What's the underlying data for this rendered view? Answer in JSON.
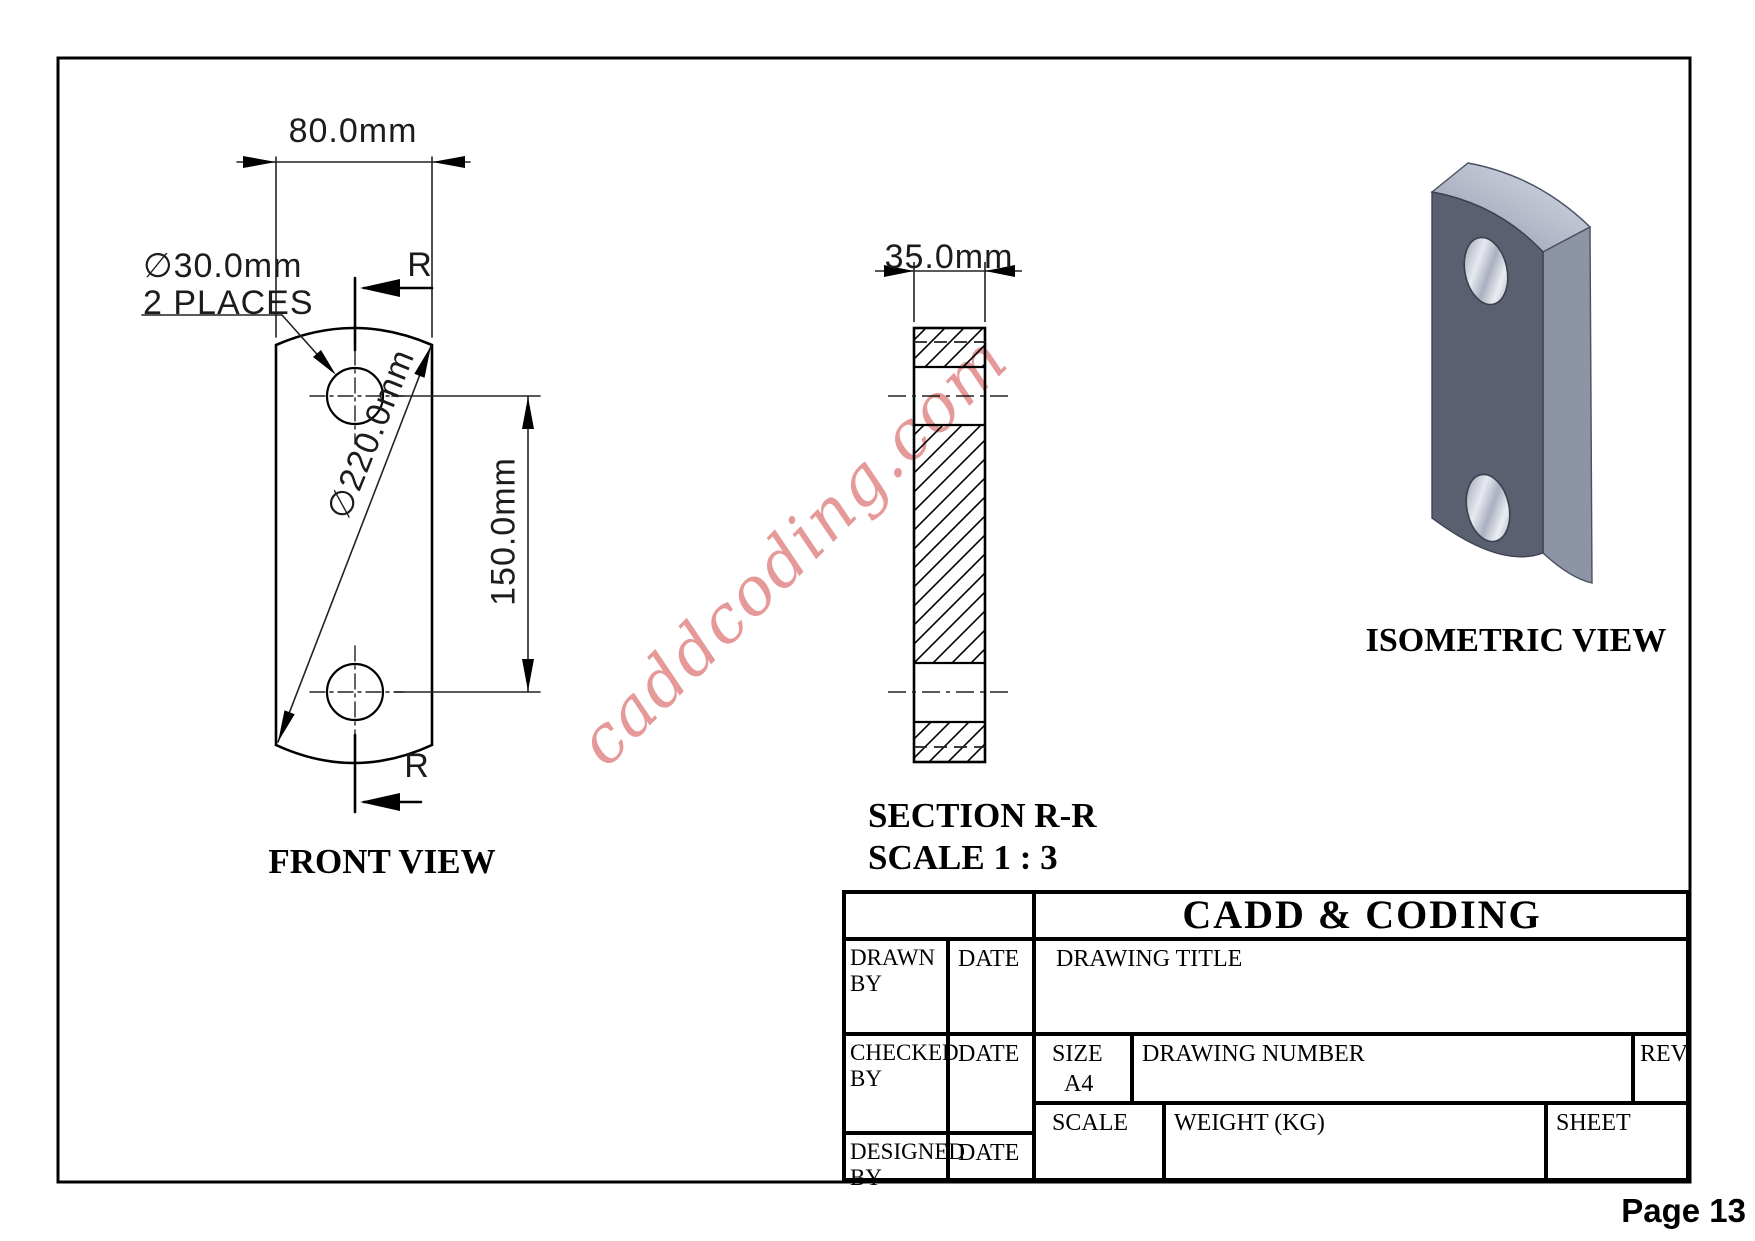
{
  "page": {
    "label": "Page 13"
  },
  "watermark": "caddcoding.com",
  "views": {
    "front": {
      "label": "FRONT VIEW"
    },
    "section": {
      "label": "SECTION R-R",
      "scale_label": "SCALE 1 : 3"
    },
    "isometric": {
      "label": "ISOMETRIC VIEW"
    }
  },
  "dimensions": {
    "plate_width": "80.0mm",
    "hole_diameter": "∅30.0mm",
    "hole_note": "2 PLACES",
    "outer_diameter": "∅220.0mm",
    "hole_spacing": "150.0mm",
    "thickness": "35.0mm",
    "section_mark_top": "R",
    "section_mark_bottom": "R"
  },
  "title_block": {
    "company": "CADD & CODING",
    "drawn_by": "DRAWN BY",
    "checked_by": "CHECKED BY",
    "designed_by": "DESIGNED BY",
    "date_drawn": "DATE",
    "date_checked": "DATE",
    "date_designed": "DATE",
    "drawing_title": "DRAWING TITLE",
    "size_label": "SIZE",
    "size_value": "A4",
    "drawing_number": "DRAWING NUMBER",
    "rev": "REV",
    "scale": "SCALE",
    "weight": "WEIGHT (KG)",
    "sheet": "SHEET"
  },
  "colors": {
    "line": "#000000",
    "watermark_pink": "#de8080",
    "iso_front_face": "#5a6070",
    "iso_side_face": "#8d94a6",
    "iso_top_face_light": "#d5d9e4",
    "iso_top_face_dark": "#8f96a8",
    "hole_bore_light": "#e8eaf1",
    "hole_bore_dark": "#8f95a5"
  }
}
